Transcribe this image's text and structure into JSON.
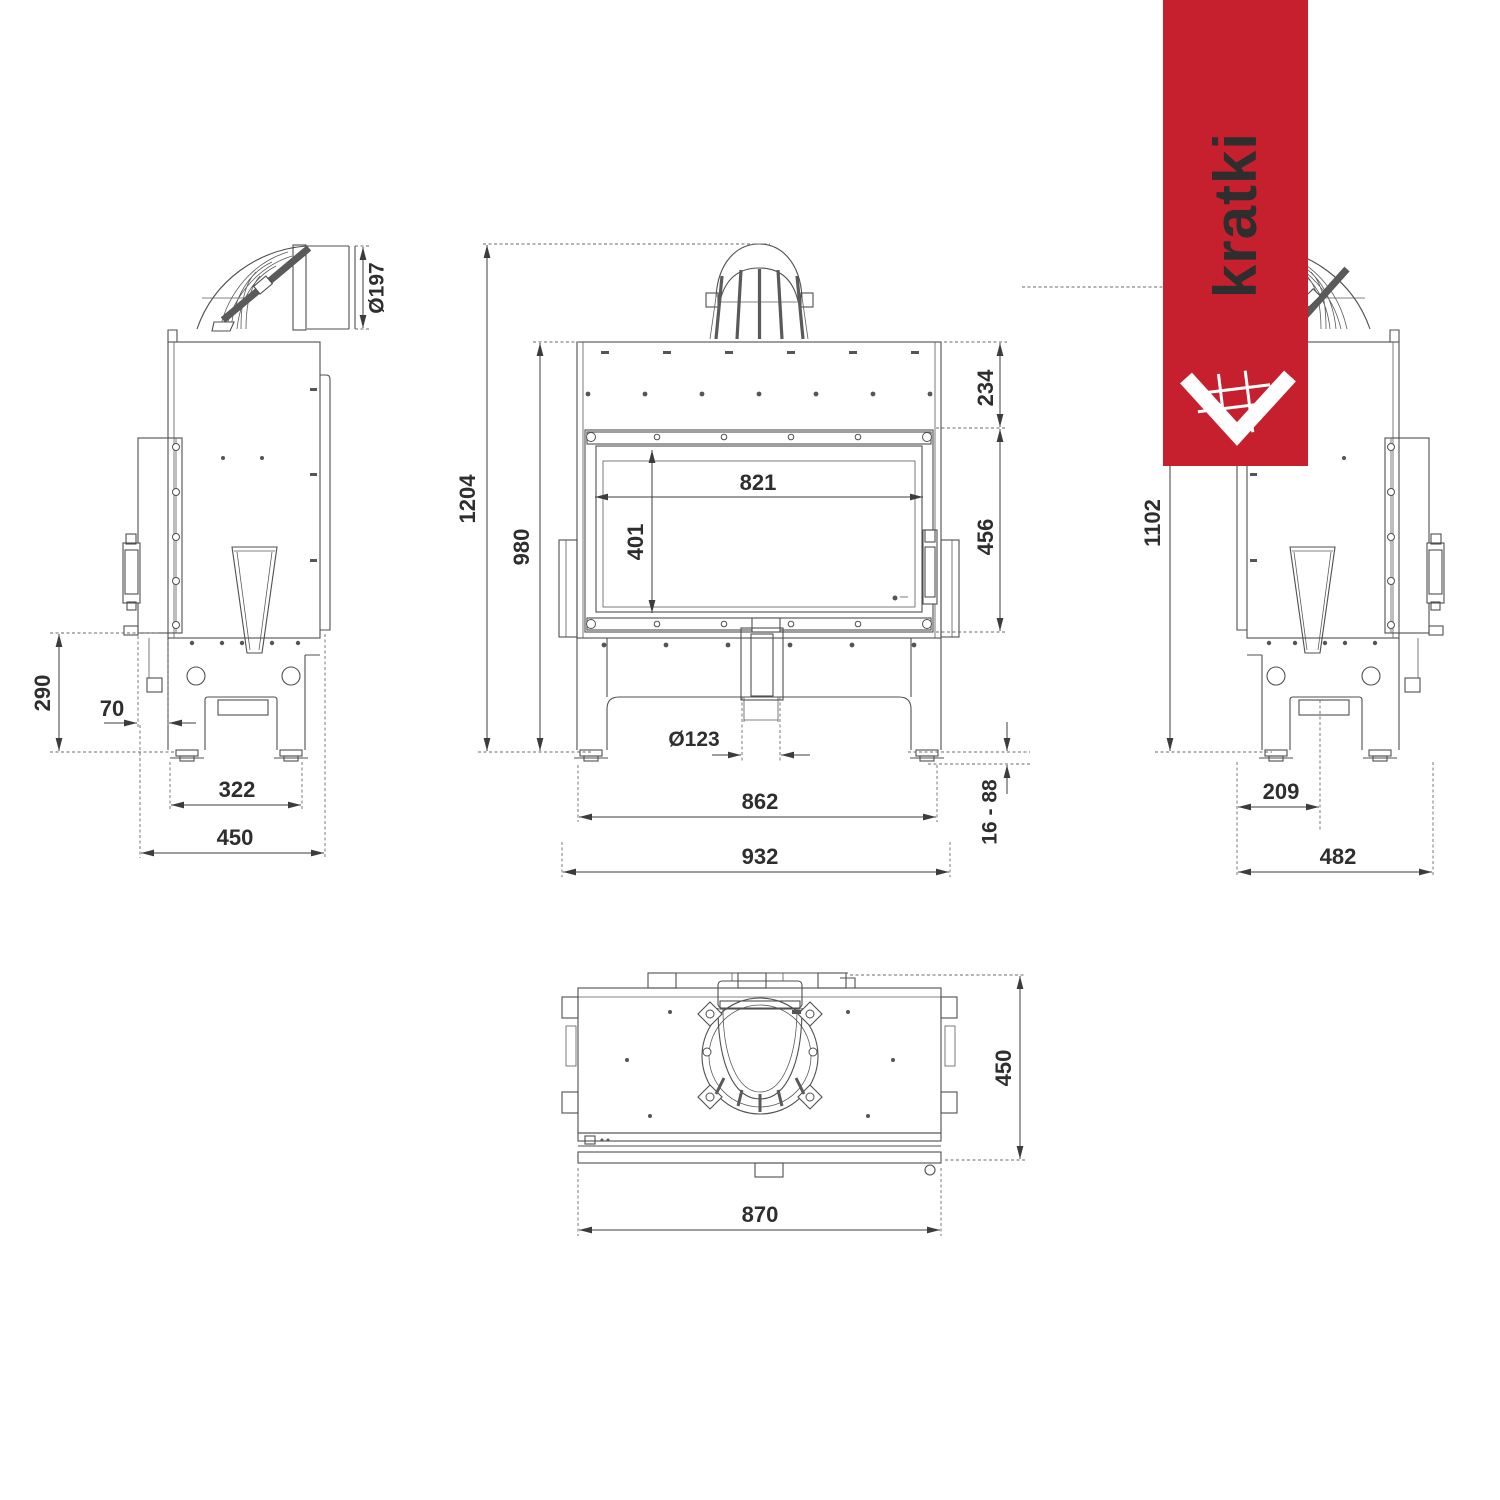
{
  "brand": {
    "logo_text": "kratki",
    "banner_color": "#c6202e"
  },
  "views": {
    "left_side": {
      "dims": {
        "flue_diameter": "Ø197",
        "rear_height": "290",
        "rail_offset": "70",
        "feet_spacing": "322",
        "depth": "450"
      }
    },
    "front": {
      "dims": {
        "total_height": "1204",
        "body_height": "980",
        "top_panel_height": "234",
        "glass_width": "821",
        "glass_height": "401",
        "door_height": "456",
        "outlet_diameter": "Ø123",
        "body_width": "862",
        "total_width": "932",
        "feet_adjust_range": "16 - 88"
      }
    },
    "right_side": {
      "dims": {
        "flue_axis_height": "1102",
        "outlet_offset": "209",
        "depth": "482"
      }
    },
    "top": {
      "dims": {
        "width": "870",
        "depth": "450"
      }
    }
  }
}
